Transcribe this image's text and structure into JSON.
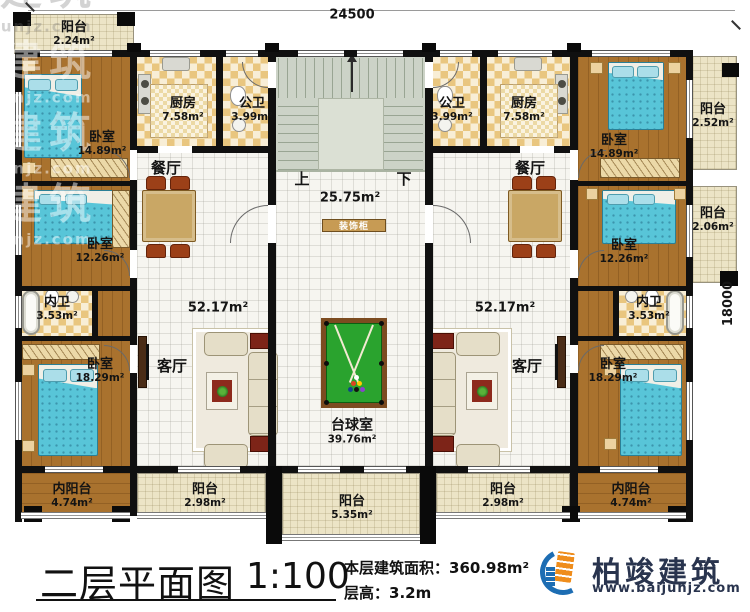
{
  "dimensions": {
    "top": "24500",
    "right": "18000"
  },
  "stairs": {
    "up": "上",
    "down": "下"
  },
  "rooms": {
    "balcony_tl": {
      "name": "阳台",
      "area": "2.24m²"
    },
    "bedroom_l1": {
      "name": "卧室",
      "area": "14.89m²"
    },
    "kitchen_l": {
      "name": "厨房",
      "area": "7.58m²"
    },
    "bath_l": {
      "name": "公卫",
      "area": "3.99m²"
    },
    "hall": {
      "area": "25.75m²"
    },
    "cabinet": {
      "name": "装饰柜"
    },
    "dining_l": {
      "name": "餐厅"
    },
    "living_l": {
      "name": "客厅",
      "area": "52.17m²"
    },
    "bedroom_l2": {
      "name": "卧室",
      "area": "12.26m²"
    },
    "ensuite_l": {
      "name": "内卫",
      "area": "3.53m²"
    },
    "bedroom_l3": {
      "name": "卧室",
      "area": "18.29m²"
    },
    "inner_balcony_l": {
      "name": "内阳台",
      "area": "4.74m²"
    },
    "balcony_bl": {
      "name": "阳台",
      "area": "2.98m²"
    },
    "balcony_bc": {
      "name": "阳台",
      "area": "5.35m²"
    },
    "billiards": {
      "name": "台球室",
      "area": "39.76m²"
    },
    "bath_r": {
      "name": "公卫",
      "area": "3.99m²"
    },
    "kitchen_r": {
      "name": "厨房",
      "area": "7.58m²"
    },
    "bedroom_r1": {
      "name": "卧室",
      "area": "14.89m²"
    },
    "balcony_r1": {
      "name": "阳台",
      "area": "2.52m²"
    },
    "dining_r": {
      "name": "餐厅"
    },
    "living_r": {
      "name": "客厅",
      "area": "52.17m²"
    },
    "bedroom_r2": {
      "name": "卧室",
      "area": "12.26m²"
    },
    "balcony_r2": {
      "name": "阳台",
      "area": "2.06m²"
    },
    "ensuite_r": {
      "name": "内卫",
      "area": "3.53m²"
    },
    "bedroom_r3": {
      "name": "卧室",
      "area": "18.29m²"
    },
    "balcony_br": {
      "name": "阳台",
      "area": "2.98m²"
    },
    "inner_balcony_r": {
      "name": "内阳台",
      "area": "4.74m²"
    }
  },
  "title_block": {
    "title": "二层平面图",
    "scale": "1:100",
    "area_label": "本层建筑面积：",
    "area_value": "360.98m²",
    "height_label": "层高：",
    "height_value": "3.2m"
  },
  "brand": {
    "name": "柏竣建筑",
    "website": "www.baijunjz.com"
  },
  "watermark": {
    "name": "柏竣建筑",
    "website": "www.baijunjz.com"
  },
  "colors": {
    "wall": "#101010",
    "wood_floor": "#a9722e",
    "balcony_tile": "#ece4c6",
    "kitchen_checker": "#e9c67f",
    "bed": "#58c5d8",
    "pool_felt": "#2aa32e",
    "brand_navy": "#29344e",
    "brand_orange": "#ef8d1c",
    "brand_blue": "#1d6db3"
  }
}
